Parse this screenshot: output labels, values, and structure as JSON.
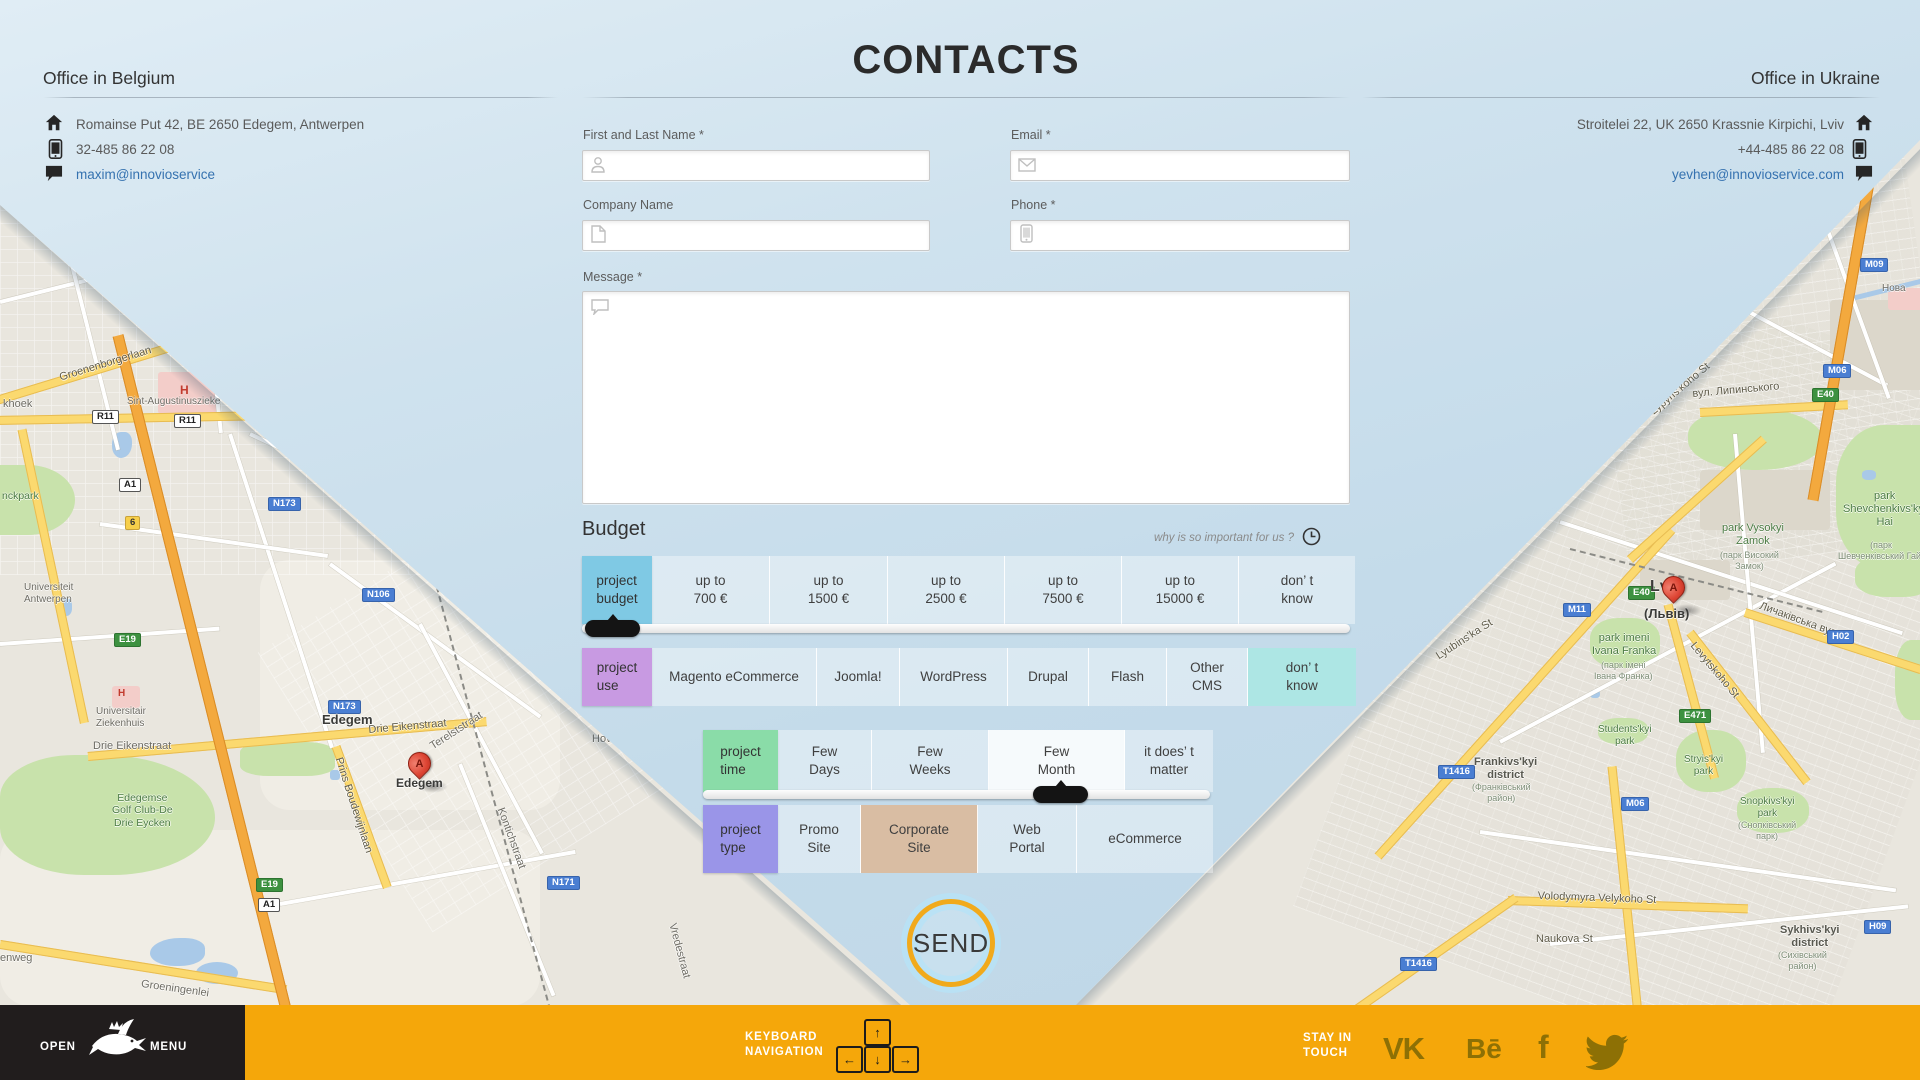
{
  "page": {
    "title": "CONTACTS"
  },
  "offices": {
    "belgium": {
      "title": "Office in Belgium",
      "address": "Romainse Put 42, BE 2650 Edegem, Antwerpen",
      "phone": "32-485 86 22 08",
      "email": "maxim@innovioservice"
    },
    "ukraine": {
      "title": "Office in Ukraine",
      "address": "Stroitelei 22, UK 2650 Krassnie Kirpichi, Lviv",
      "phone": "+44-485 86 22 08",
      "email": "yevhen@innovioservice.com"
    }
  },
  "form": {
    "name_label": "First and Last Name *",
    "email_label": "Email *",
    "company_label": "Company Name",
    "phone_label": "Phone *",
    "message_label": "Message *"
  },
  "budget": {
    "heading": "Budget",
    "why_link": "why is so important for us ?",
    "rows": [
      {
        "name": "project-budget",
        "label": "project\nbudget",
        "color": "#7fc9e4",
        "x": 582,
        "y": 556,
        "h": 68,
        "labelW": 70,
        "cells": [
          {
            "t": "up to\n700 €",
            "w": 117
          },
          {
            "t": "up to\n1500 €",
            "w": 117
          },
          {
            "t": "up to\n2500 €",
            "w": 116
          },
          {
            "t": "up to\n7500 €",
            "w": 116
          },
          {
            "t": "up to\n15000 €",
            "w": 116
          },
          {
            "t": "don’ t\nknow",
            "w": 116
          }
        ],
        "slider": {
          "x": 582,
          "y": 624,
          "w": 768,
          "handle": 3
        }
      },
      {
        "name": "project-use",
        "label": "project\nuse",
        "color": "#c89ae2",
        "x": 582,
        "y": 648,
        "h": 58,
        "labelW": 70,
        "cells": [
          {
            "t": "Magento eCommerce",
            "w": 164
          },
          {
            "t": "Joomla!",
            "w": 82
          },
          {
            "t": "WordPress",
            "w": 107
          },
          {
            "t": "Drupal",
            "w": 80
          },
          {
            "t": "Flash",
            "w": 77
          },
          {
            "t": "Other\nCMS",
            "w": 80
          },
          {
            "t": "don’ t\nknow",
            "w": 108,
            "bg": "#ade6e4"
          }
        ]
      },
      {
        "name": "project-time",
        "label": "project\ntime",
        "color": "#8adca8",
        "x": 703,
        "y": 730,
        "h": 62,
        "labelW": 75,
        "cells": [
          {
            "t": "Few\nDays",
            "w": 93
          },
          {
            "t": "Few\nWeeks",
            "w": 116
          },
          {
            "t": "Few\nMonth",
            "w": 135,
            "bg": "rgba(255,255,255,0.85)"
          },
          {
            "t": "it does’ t\nmatter",
            "w": 88
          }
        ],
        "slider": {
          "x": 703,
          "y": 790,
          "w": 507,
          "handle": 330
        }
      },
      {
        "name": "project-type",
        "label": "project\ntype",
        "color": "#9a95e8",
        "x": 703,
        "y": 805,
        "h": 68,
        "labelW": 75,
        "cells": [
          {
            "t": "Promo\nSite",
            "w": 82
          },
          {
            "t": "Corporate\nSite",
            "w": 116,
            "bg": "#d9bda3"
          },
          {
            "t": "Web\nPortal",
            "w": 98
          },
          {
            "t": "eCommerce",
            "w": 136
          }
        ]
      }
    ]
  },
  "send_label": "SEND",
  "footer": {
    "open": "OPEN",
    "menu": "MENU",
    "keyboard_line1": "KEYBOARD",
    "keyboard_line2": "NAVIGATION",
    "keys": {
      "up": "↑",
      "left": "←",
      "down": "↓",
      "right": "→"
    },
    "stay_line1": "STAY IN",
    "stay_line2": "TOUCH",
    "social": {
      "vk": "VK",
      "behance": "Bē",
      "facebook": "f",
      "twitter": "twitter-bird"
    }
  },
  "colors": {
    "accent_orange": "#f5a70a",
    "send_ring": "#f1aa1c",
    "footer_black": "#211d1d",
    "link_blue": "#3572b0"
  },
  "maps": {
    "left": {
      "marker": {
        "x": 408,
        "y": 752,
        "letter": "A"
      },
      "labels": [
        {
          "t": "Groenenborgerlaan",
          "x": 58,
          "y": 372,
          "cls": "rd",
          "rot": -17
        },
        {
          "t": "khoek",
          "x": 3,
          "y": 398,
          "cls": "st"
        },
        {
          "t": "Sint-Augustinuszieke",
          "x": 127,
          "y": 396,
          "cls": "st",
          "fs": 10
        },
        {
          "t": "H",
          "x": 180,
          "y": 383,
          "cls": "hosp-h"
        },
        {
          "t": "R11",
          "x": 92,
          "y": 410,
          "cls": "sh-w"
        },
        {
          "t": "R11",
          "x": 174,
          "y": 414,
          "cls": "sh-w"
        },
        {
          "t": "A1",
          "x": 119,
          "y": 478,
          "cls": "sh-w"
        },
        {
          "t": "6",
          "x": 125,
          "y": 516,
          "cls": "sh-x"
        },
        {
          "t": "N173",
          "x": 268,
          "y": 497,
          "cls": "sh-b"
        },
        {
          "t": "nckpark",
          "x": 2,
          "y": 490,
          "cls": "pk"
        },
        {
          "t": "Universiteit\nAntwerpen",
          "x": 24,
          "y": 582,
          "cls": "st",
          "fs": 10
        },
        {
          "t": "N106",
          "x": 362,
          "y": 588,
          "cls": "sh-b"
        },
        {
          "t": "N173",
          "x": 328,
          "y": 700,
          "cls": "sh-b"
        },
        {
          "t": "E19",
          "x": 114,
          "y": 633,
          "cls": "sh-g"
        },
        {
          "t": "H",
          "x": 118,
          "y": 688,
          "cls": "hosp-h",
          "fs": 10
        },
        {
          "t": "Universitair\nZiekenhuis",
          "x": 96,
          "y": 706,
          "cls": "st",
          "fs": 10
        },
        {
          "t": "Drie Eikenstraat",
          "x": 93,
          "y": 740,
          "cls": "st"
        },
        {
          "t": "Edegem",
          "x": 322,
          "y": 712,
          "cls": "city"
        },
        {
          "t": "Drie Eikenstraat",
          "x": 368,
          "y": 724,
          "cls": "rd",
          "rot": -5
        },
        {
          "t": "Terelststraat",
          "x": 428,
          "y": 742,
          "cls": "st",
          "rot": -33
        },
        {
          "t": "Hove",
          "x": 592,
          "y": 733,
          "cls": "st"
        },
        {
          "t": "Prins Boudewijnlaan",
          "x": 344,
          "y": 756,
          "cls": "rd",
          "rot": 72
        },
        {
          "t": "Edegem",
          "x": 396,
          "y": 776,
          "cls": "city",
          "fs": 12
        },
        {
          "t": "Kontichstraat",
          "x": 506,
          "y": 806,
          "cls": "st",
          "rot": 70
        },
        {
          "t": "Edegemse\nGolf Club-De\nDrie Eycken",
          "x": 112,
          "y": 792,
          "cls": "pk",
          "fs": 10.5
        },
        {
          "t": "E19",
          "x": 256,
          "y": 878,
          "cls": "sh-g"
        },
        {
          "t": "A1",
          "x": 258,
          "y": 898,
          "cls": "sh-w"
        },
        {
          "t": "N171",
          "x": 547,
          "y": 876,
          "cls": "sh-b"
        },
        {
          "t": "Vredestraat",
          "x": 678,
          "y": 922,
          "cls": "st",
          "rot": 75
        },
        {
          "t": "Groeningenlei",
          "x": 142,
          "y": 978,
          "cls": "st",
          "rot": 8
        },
        {
          "t": "enweg",
          "x": 0,
          "y": 952,
          "cls": "st"
        }
      ]
    },
    "right": {
      "marker": {
        "x": 1662,
        "y": 576,
        "letter": "A"
      },
      "labels": [
        {
          "t": "M09",
          "x": 1860,
          "y": 258,
          "cls": "sh-b"
        },
        {
          "t": "Нова",
          "x": 1882,
          "y": 283,
          "cls": "st",
          "fs": 10
        },
        {
          "t": "M06",
          "x": 1823,
          "y": 364,
          "cls": "sh-b"
        },
        {
          "t": "E40",
          "x": 1812,
          "y": 388,
          "cls": "sh-g"
        },
        {
          "t": "вул. Липинського",
          "x": 1692,
          "y": 388,
          "cls": "rd",
          "rot": -5
        },
        {
          "t": "Lypyns'koho St",
          "x": 1648,
          "y": 408,
          "cls": "rd",
          "rot": -40
        },
        {
          "t": "park\nShevchenkivs'kyi\nHai",
          "x": 1843,
          "y": 490,
          "cls": "pk",
          "fs": 11
        },
        {
          "t": "(парк\nШевченківський Гай)",
          "x": 1838,
          "y": 540,
          "cls": "pk-sub"
        },
        {
          "t": "park Vysokyi\nZamok",
          "x": 1722,
          "y": 522,
          "cls": "pk",
          "fs": 11
        },
        {
          "t": "(парк Високий\nЗамок)",
          "x": 1720,
          "y": 550,
          "cls": "pk-sub"
        },
        {
          "t": "E40",
          "x": 1628,
          "y": 586,
          "cls": "sh-g"
        },
        {
          "t": "M11",
          "x": 1563,
          "y": 603,
          "cls": "sh-b"
        },
        {
          "t": "Lviv",
          "x": 1650,
          "y": 578,
          "cls": "city",
          "fs": 16
        },
        {
          "t": "(Львів)",
          "x": 1644,
          "y": 606,
          "cls": "city",
          "fs": 13
        },
        {
          "t": "Личаківська вул.",
          "x": 1762,
          "y": 600,
          "cls": "rd",
          "rot": 20
        },
        {
          "t": "H02",
          "x": 1827,
          "y": 630,
          "cls": "sh-b"
        },
        {
          "t": "park imeni\nIvana Franka",
          "x": 1592,
          "y": 632,
          "cls": "pk",
          "fs": 11
        },
        {
          "t": "(парк імені\nІвана Франка)",
          "x": 1594,
          "y": 660,
          "cls": "pk-sub"
        },
        {
          "t": "Levytskoho St",
          "x": 1697,
          "y": 640,
          "cls": "rd",
          "rot": 50
        },
        {
          "t": "Lyubins'ka St",
          "x": 1434,
          "y": 652,
          "cls": "rd",
          "rot": -33
        },
        {
          "t": "Students'kyi\npark",
          "x": 1598,
          "y": 724,
          "cls": "pk",
          "fs": 10
        },
        {
          "t": "E471",
          "x": 1679,
          "y": 709,
          "cls": "sh-g"
        },
        {
          "t": "T1416",
          "x": 1438,
          "y": 765,
          "cls": "sh-b"
        },
        {
          "t": "Frankivs'kyi\ndistrict",
          "x": 1474,
          "y": 756,
          "cls": "dist"
        },
        {
          "t": "(Франківський\nрайон)",
          "x": 1472,
          "y": 782,
          "cls": "pk-sub"
        },
        {
          "t": "Stryis'kyi\npark",
          "x": 1684,
          "y": 754,
          "cls": "pk",
          "fs": 10
        },
        {
          "t": "M06",
          "x": 1621,
          "y": 797,
          "cls": "sh-b"
        },
        {
          "t": "Snopkivs'kyi\npark",
          "x": 1740,
          "y": 796,
          "cls": "pk",
          "fs": 10
        },
        {
          "t": "(Снопківський\nпарк)",
          "x": 1738,
          "y": 820,
          "cls": "pk-sub"
        },
        {
          "t": "Volodymyra Velykoho St",
          "x": 1538,
          "y": 890,
          "cls": "rd",
          "rot": 2
        },
        {
          "t": "Naukova St",
          "x": 1536,
          "y": 933,
          "cls": "rd"
        },
        {
          "t": "Sykhivs'kyi\ndistrict",
          "x": 1780,
          "y": 924,
          "cls": "dist"
        },
        {
          "t": "(Сихівський\nрайон)",
          "x": 1778,
          "y": 950,
          "cls": "pk-sub"
        },
        {
          "t": "H09",
          "x": 1864,
          "y": 920,
          "cls": "sh-b"
        },
        {
          "t": "T1416",
          "x": 1400,
          "y": 957,
          "cls": "sh-b"
        }
      ]
    }
  }
}
